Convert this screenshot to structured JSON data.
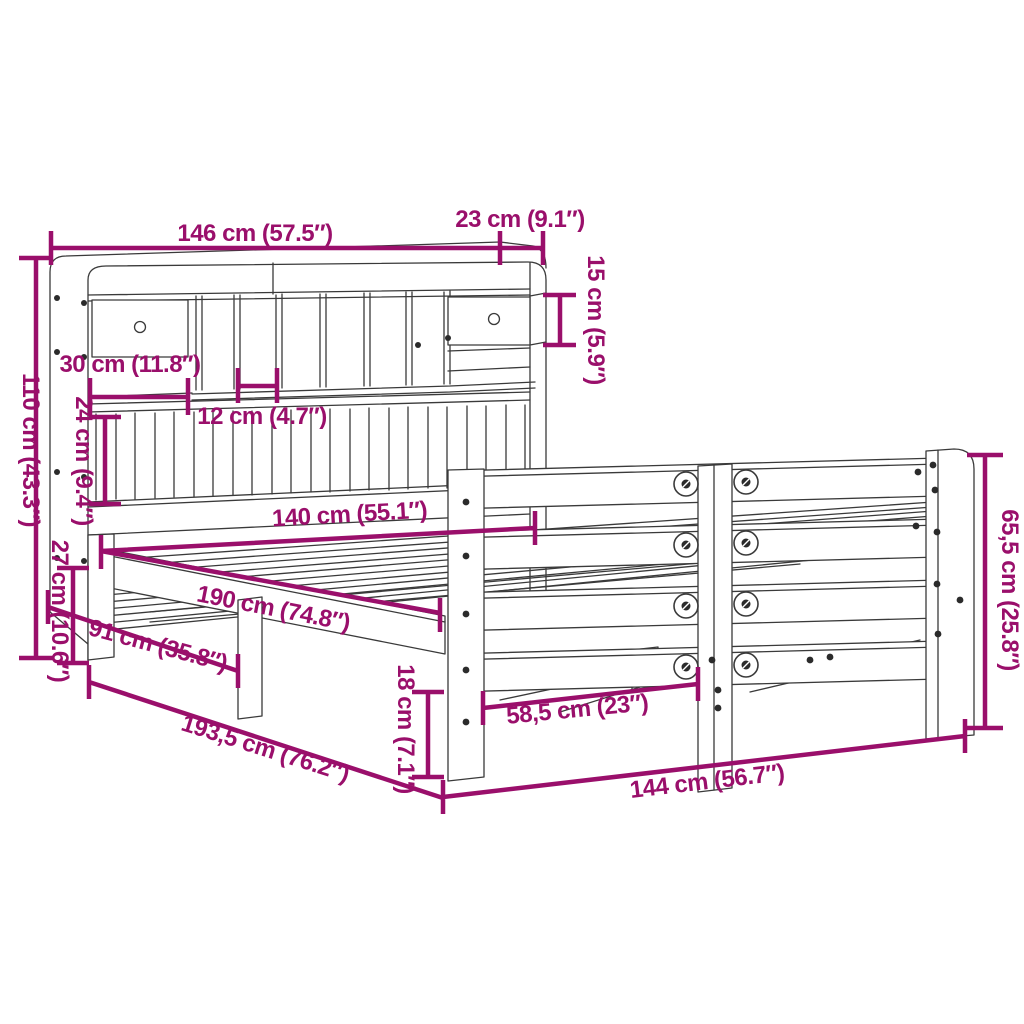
{
  "diagram": {
    "kind": "product-dimension-diagram",
    "background_color": "#ffffff",
    "drawing_line_color": "#3a3a3a",
    "dimension_color": "#9a0f6b"
  },
  "dimensions": [
    {
      "name": "headboard-total-width",
      "label": "146 cm (57.5″)"
    },
    {
      "name": "headboard-top-depth",
      "label": "23 cm (9.1″)"
    },
    {
      "name": "top-shelf-height",
      "label": "15 cm (5.9″)"
    },
    {
      "name": "headboard-height",
      "label": "110 cm (43.3″)"
    },
    {
      "name": "shelf-opening-width",
      "label": "30 cm (11.8″)"
    },
    {
      "name": "compartment-width",
      "label": "12 cm (4.7″)"
    },
    {
      "name": "slat-panel-height",
      "label": "24 cm (9.4″)"
    },
    {
      "name": "frame-side-height",
      "label": "27 cm (10.6″)"
    },
    {
      "name": "mattress-width",
      "label": "140 cm (55.1″)"
    },
    {
      "name": "mattress-length",
      "label": "190 cm (74.8″)"
    },
    {
      "name": "side-shelf-depth",
      "label": "91 cm (35.8″)"
    },
    {
      "name": "total-length",
      "label": "193,5 cm (76.2″)"
    },
    {
      "name": "under-bed-clearance",
      "label": "18 cm (7.1″)"
    },
    {
      "name": "leg-spacing",
      "label": "58,5 cm (23″)"
    },
    {
      "name": "footboard-width",
      "label": "144 cm (56.7″)"
    },
    {
      "name": "footboard-height",
      "label": "65,5 cm (25.8″)"
    }
  ]
}
